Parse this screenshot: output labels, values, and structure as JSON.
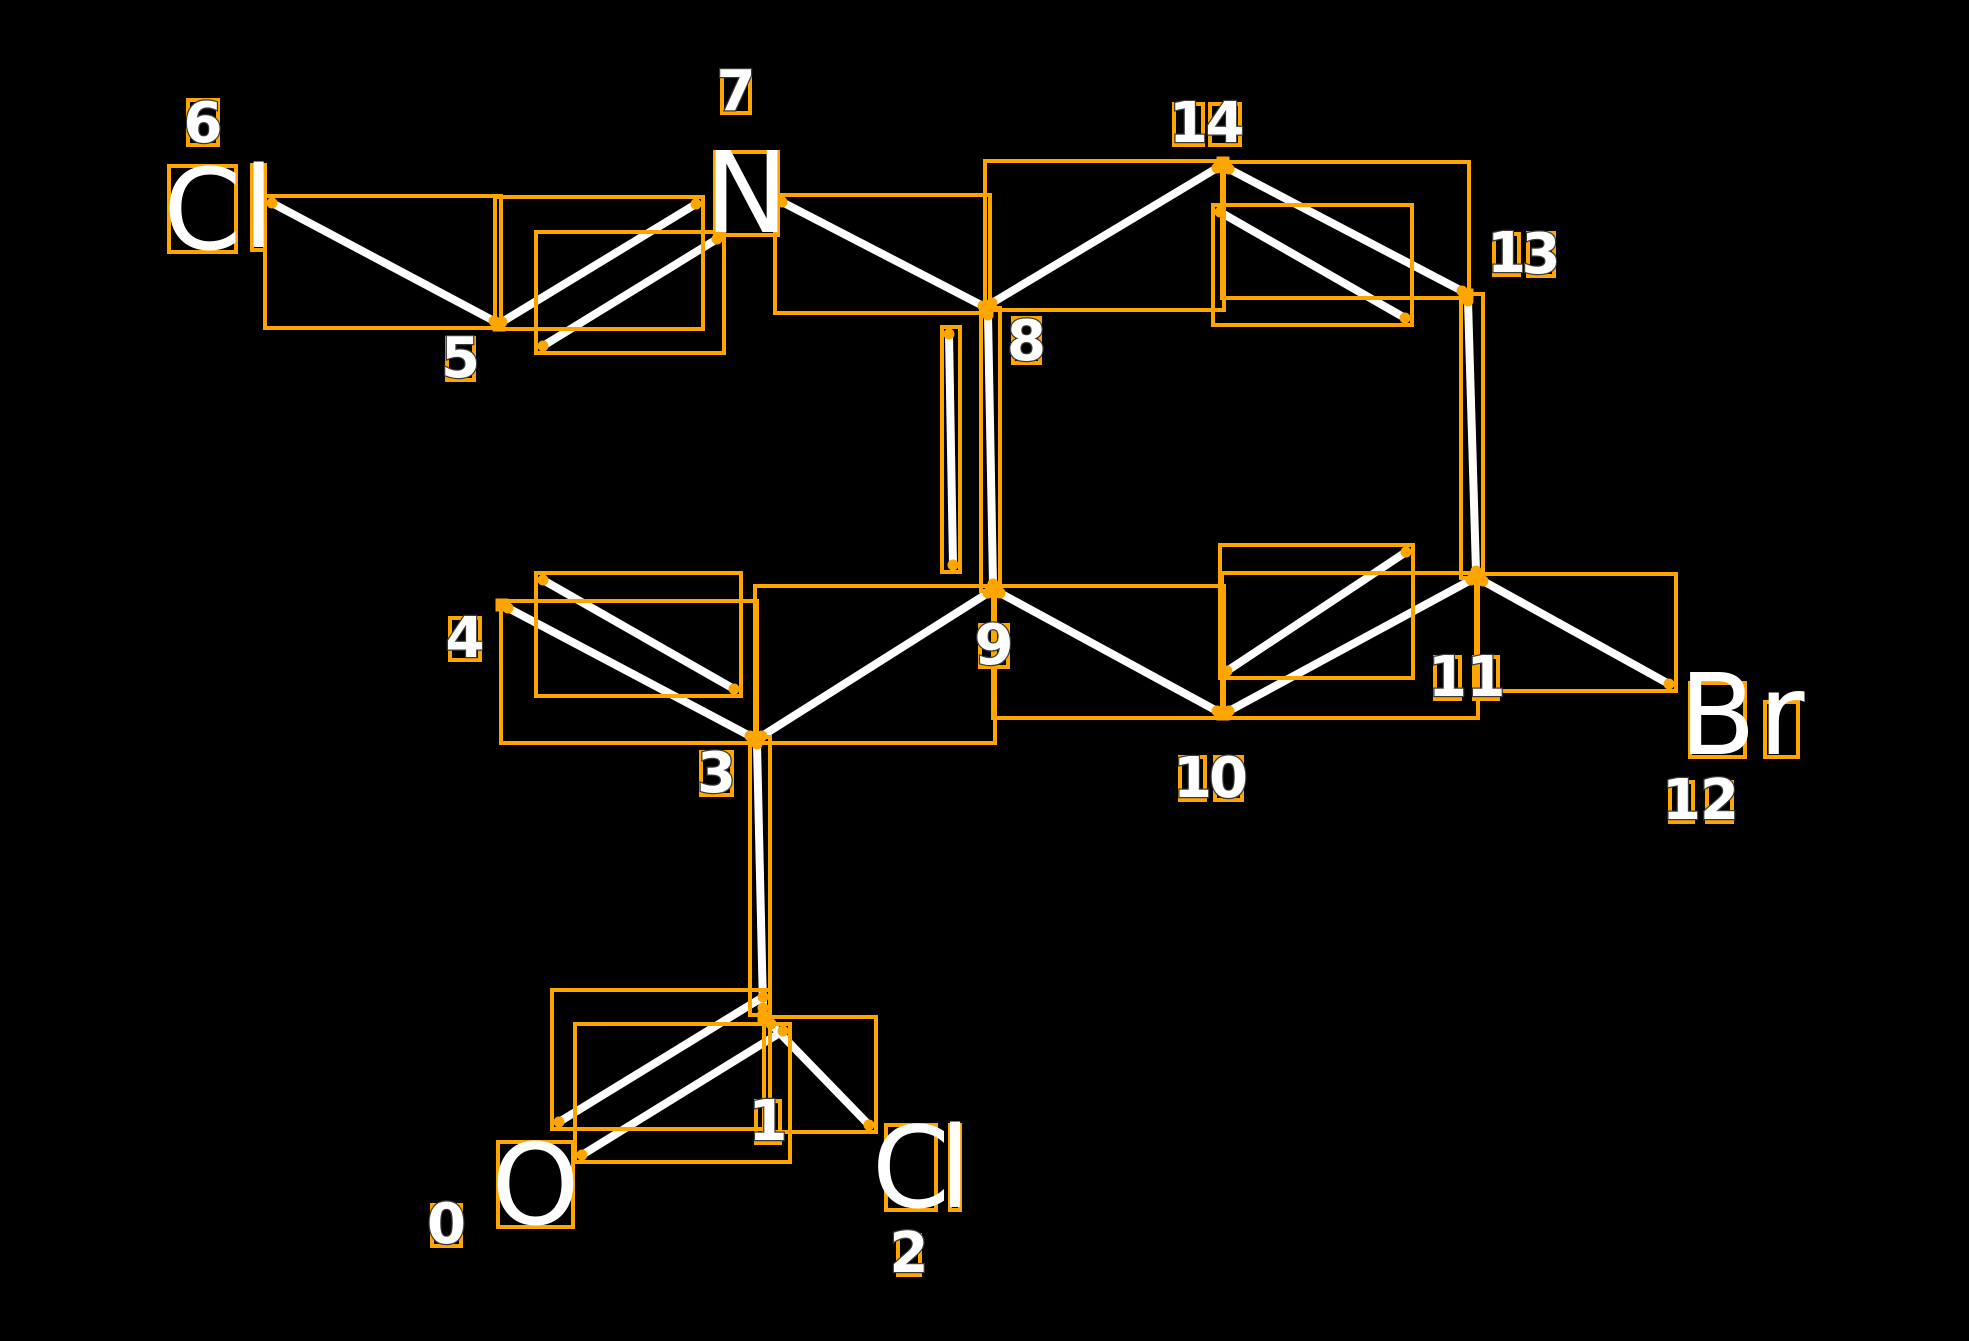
{
  "canvas": {
    "width": 1969,
    "height": 1341,
    "background": "#000000"
  },
  "style": {
    "box_color": "#FFA500",
    "bond_color": "#FFFFFF",
    "text_color": "#FFFFFF",
    "bond_width": 8,
    "box_stroke": 4,
    "box_pad": 7,
    "dot_radius": 5.5,
    "marker_size": 13,
    "symbol_font_size": 112,
    "digit_font_size": 56
  },
  "molecule": {
    "atoms": [
      {
        "index": 0,
        "symbol": "O",
        "glyphs": [
          {
            "ch": "O",
            "box": [
              498,
              1142,
              573,
              1227
            ]
          }
        ],
        "index_digits": [
          {
            "ch": "0",
            "box": [
              432,
              1205,
              461,
              1246
            ]
          }
        ]
      },
      {
        "index": 1,
        "symbol": "C",
        "vertex": [
          764,
          1018
        ],
        "index_digits": [
          {
            "ch": "1",
            "box": [
              756,
              1101,
              780,
              1143
            ]
          }
        ]
      },
      {
        "index": 2,
        "symbol": "Cl",
        "glyphs": [
          {
            "ch": "C",
            "box": [
              886,
              1125,
              936,
              1210
            ]
          },
          {
            "ch": "l",
            "box": [
              950,
              1125,
              960,
              1210
            ]
          }
        ],
        "index_digits": [
          {
            "ch": "2",
            "box": [
              898,
              1235,
              920,
              1275
            ]
          }
        ]
      },
      {
        "index": 3,
        "symbol": "C",
        "vertex": [
          756,
          738
        ],
        "index_digits": [
          {
            "ch": "3",
            "box": [
              701,
              752,
              732,
              795
            ]
          }
        ]
      },
      {
        "index": 4,
        "symbol": "C",
        "vertex": [
          502,
          605
        ],
        "index_digits": [
          {
            "ch": "4",
            "box": [
              450,
              618,
              480,
              660
            ]
          }
        ]
      },
      {
        "index": 5,
        "symbol": "C",
        "vertex": [
          499,
          325
        ],
        "index_digits": [
          {
            "ch": "5",
            "box": [
              447,
              338,
              474,
              380
            ]
          }
        ]
      },
      {
        "index": 6,
        "symbol": "Cl",
        "glyphs": [
          {
            "ch": "C",
            "box": [
              169,
              166,
              236,
              252
            ]
          },
          {
            "ch": "l",
            "box": [
              252,
              165,
              265,
              250
            ]
          }
        ],
        "index_digits": [
          {
            "ch": "6",
            "box": [
              188,
              100,
              218,
              145
            ]
          }
        ]
      },
      {
        "index": 7,
        "symbol": "N",
        "glyphs": [
          {
            "ch": "N",
            "box": [
              715,
              152,
              778,
              235
            ]
          }
        ],
        "index_digits": [
          {
            "ch": "7",
            "box": [
              722,
              73,
              750,
              113
            ]
          }
        ]
      },
      {
        "index": 8,
        "symbol": "C",
        "vertex": [
          987,
          309
        ],
        "index_digits": [
          {
            "ch": "8",
            "box": [
              1013,
              318,
              1040,
              363
            ]
          }
        ]
      },
      {
        "index": 9,
        "symbol": "C",
        "vertex": [
          994,
          590
        ],
        "index_digits": [
          {
            "ch": "9",
            "box": [
              980,
              625,
              1008,
              667
            ]
          }
        ]
      },
      {
        "index": 10,
        "symbol": "C",
        "vertex": [
          1223,
          714
        ],
        "index_digits": [
          {
            "ch": "1",
            "box": [
              1180,
              757,
              1205,
              800
            ]
          },
          {
            "ch": "0",
            "box": [
              1215,
              757,
              1242,
              800
            ]
          }
        ]
      },
      {
        "index": 11,
        "symbol": "C",
        "vertex": [
          1477,
          577
        ],
        "index_digits": [
          {
            "ch": "1",
            "box": [
              1435,
              657,
              1460,
              699
            ]
          },
          {
            "ch": "1",
            "box": [
              1474,
              657,
              1498,
              699
            ]
          }
        ]
      },
      {
        "index": 12,
        "symbol": "Br",
        "glyphs": [
          {
            "ch": "B",
            "box": [
              1690,
              683,
              1745,
              757
            ]
          },
          {
            "ch": "r",
            "box": [
              1765,
              702,
              1798,
              757
            ]
          }
        ],
        "index_digits": [
          {
            "ch": "1",
            "box": [
              1670,
              782,
              1693,
              822
            ]
          },
          {
            "ch": "2",
            "box": [
              1707,
              782,
              1732,
              822
            ]
          }
        ]
      },
      {
        "index": 13,
        "symbol": "C",
        "vertex": [
          1467,
          295
        ],
        "index_digits": [
          {
            "ch": "1",
            "box": [
              1494,
              234,
              1519,
              275
            ]
          },
          {
            "ch": "3",
            "box": [
              1528,
              233,
              1554,
              276
            ]
          }
        ]
      },
      {
        "index": 14,
        "symbol": "C",
        "vertex": [
          1223,
          163
        ],
        "index_digits": [
          {
            "ch": "1",
            "box": [
              1174,
              104,
              1203,
              145
            ]
          },
          {
            "ch": "4",
            "box": [
              1210,
              104,
              1240,
              145
            ]
          }
        ]
      }
    ],
    "bonds": [
      {
        "atoms": [
          6,
          5
        ],
        "order": 1,
        "lines": [
          [
            272,
            203,
            494,
            321
          ]
        ]
      },
      {
        "atoms": [
          5,
          7
        ],
        "order": 2,
        "lines": [
          [
            502,
            322,
            696,
            204
          ],
          [
            543,
            346,
            717,
            239
          ]
        ]
      },
      {
        "atoms": [
          7,
          8
        ],
        "order": 1,
        "lines": [
          [
            782,
            202,
            983,
            306
          ]
        ]
      },
      {
        "atoms": [
          8,
          14
        ],
        "order": 1,
        "lines": [
          [
            992,
            303,
            1217,
            168
          ]
        ]
      },
      {
        "atoms": [
          14,
          13
        ],
        "order": 2,
        "lines": [
          [
            1229,
            169,
            1462,
            291
          ],
          [
            1220,
            212,
            1405,
            318
          ]
        ]
      },
      {
        "atoms": [
          13,
          11
        ],
        "order": 1,
        "lines": [
          [
            1468,
            301,
            1476,
            571
          ]
        ]
      },
      {
        "atoms": [
          11,
          12
        ],
        "order": 1,
        "lines": [
          [
            1483,
            581,
            1669,
            684
          ]
        ]
      },
      {
        "atoms": [
          10,
          11
        ],
        "order": 2,
        "lines": [
          [
            1229,
            711,
            1471,
            580
          ],
          [
            1227,
            671,
            1406,
            552
          ]
        ]
      },
      {
        "atoms": [
          9,
          10
        ],
        "order": 1,
        "lines": [
          [
            1000,
            593,
            1217,
            711
          ]
        ]
      },
      {
        "atoms": [
          8,
          9
        ],
        "order": 2,
        "lines": [
          [
            988,
            315,
            993,
            584
          ],
          [
            949,
            334,
            953,
            565
          ]
        ]
      },
      {
        "atoms": [
          9,
          3
        ],
        "order": 1,
        "lines": [
          [
            988,
            593,
            762,
            736
          ]
        ]
      },
      {
        "atoms": [
          3,
          4
        ],
        "order": 2,
        "lines": [
          [
            750,
            736,
            508,
            608
          ],
          [
            734,
            689,
            543,
            580
          ]
        ]
      },
      {
        "atoms": [
          3,
          1
        ],
        "order": 1,
        "lines": [
          [
            757,
            744,
            763,
            1008
          ]
        ]
      },
      {
        "atoms": [
          1,
          0
        ],
        "order": 2,
        "lines": [
          [
            763,
            997,
            559,
            1122
          ],
          [
            783,
            1031,
            582,
            1155
          ]
        ]
      },
      {
        "atoms": [
          1,
          2
        ],
        "order": 1,
        "lines": [
          [
            771,
            1024,
            869,
            1125
          ]
        ]
      }
    ]
  }
}
